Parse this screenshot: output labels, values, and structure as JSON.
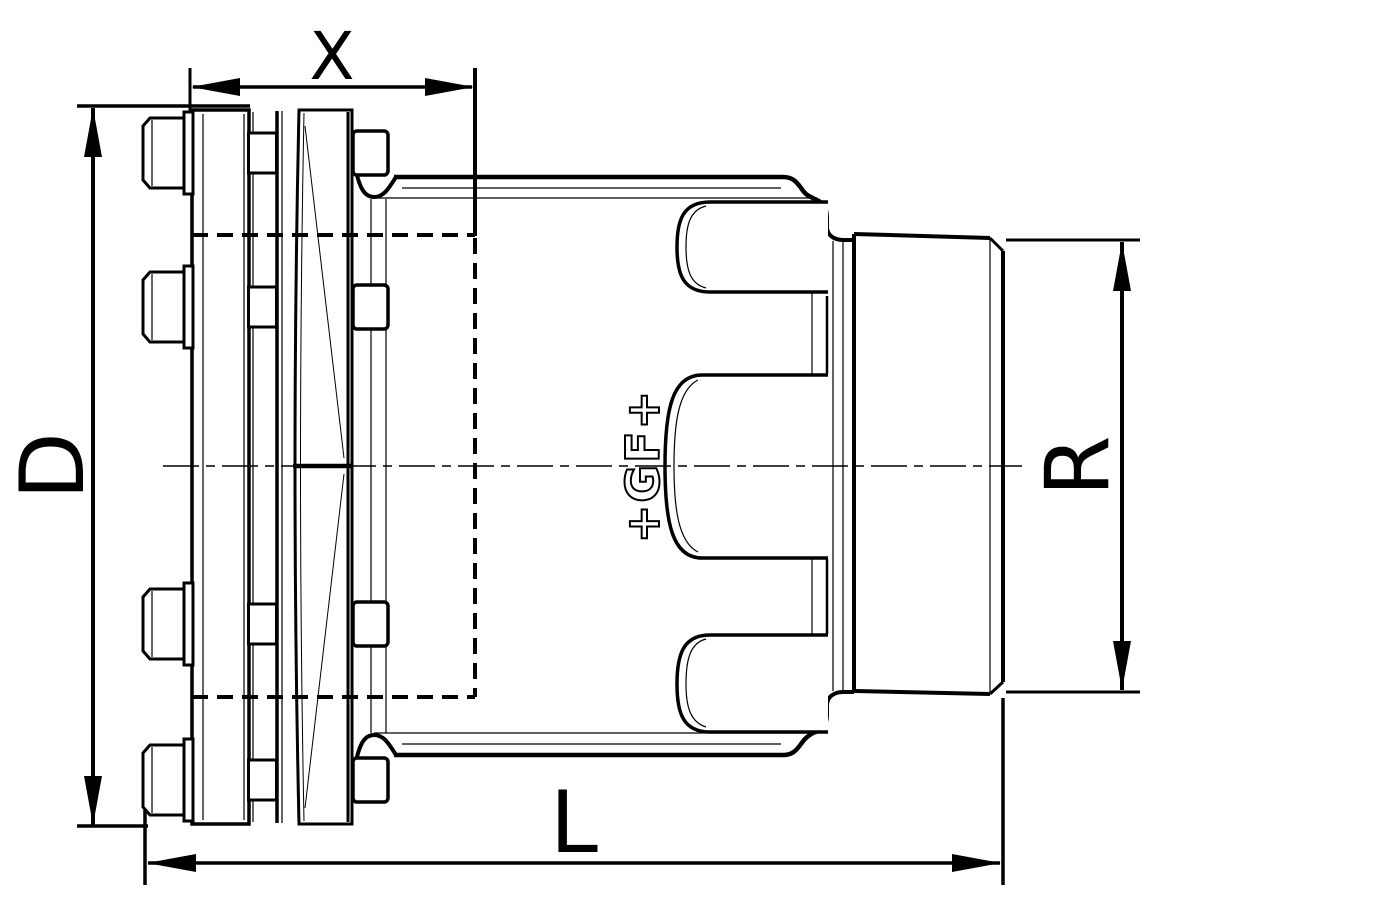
{
  "drawing": {
    "type": "technical-drawing",
    "background_color": "#ffffff",
    "line_color": "#000000",
    "dimensions": {
      "top_label": "X",
      "left_label": "D",
      "right_label": "R",
      "bottom_label": "L"
    },
    "logo": "+GF+"
  }
}
